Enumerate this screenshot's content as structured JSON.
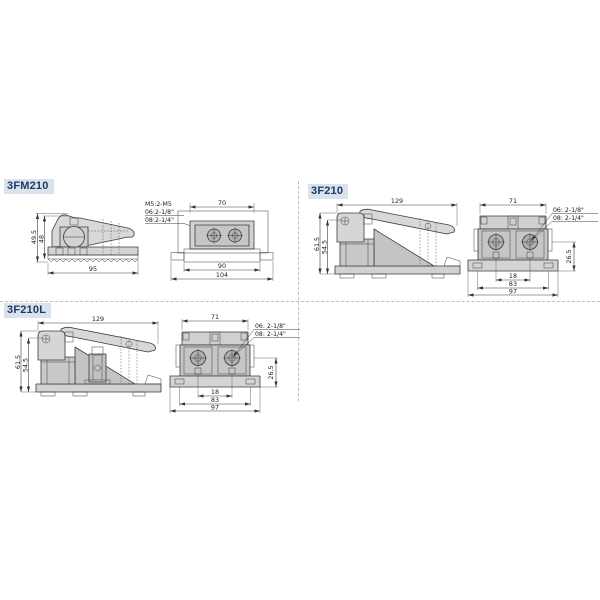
{
  "page": {
    "background": "#ffffff"
  },
  "colors": {
    "label_bg": "#d9e3ee",
    "label_fg": "#1c3a64",
    "drawing_line": "#3c3c3c",
    "fill_light": "#d8d8d8",
    "fill_mid": "#c6c6c6",
    "fill_dark": "#b0b0b0",
    "divider": "#b9c0c7"
  },
  "sections": [
    {
      "id": "3fm210",
      "label": "3FM210",
      "side": {
        "h1": "49.5",
        "h2": "48",
        "w": "95"
      },
      "top": {
        "note1": "M5:2-M5",
        "note2": "06:2-1/8\"",
        "note3": "08:2-1/4\"",
        "w_top": "70",
        "w_mid": "90",
        "w_bot": "104"
      }
    },
    {
      "id": "3f210",
      "label": "3F210",
      "side": {
        "w": "129",
        "h1": "61.5",
        "h2": "54.5"
      },
      "front": {
        "w_top": "71",
        "note1": "06: 2-1/8\"",
        "note2": "08: 2-1/4\"",
        "h_right": "26.5",
        "w1": "18",
        "w2": "83",
        "w3": "97"
      }
    },
    {
      "id": "3f210l",
      "label": "3F210L",
      "side": {
        "w": "129",
        "h1": "61.5",
        "h2": "54.5"
      },
      "front": {
        "w_top": "71",
        "note1": "06: 2-1/8\"",
        "note2": "08: 2-1/4\"",
        "h_right": "26.5",
        "w1": "18",
        "w2": "83",
        "w3": "97"
      }
    }
  ]
}
